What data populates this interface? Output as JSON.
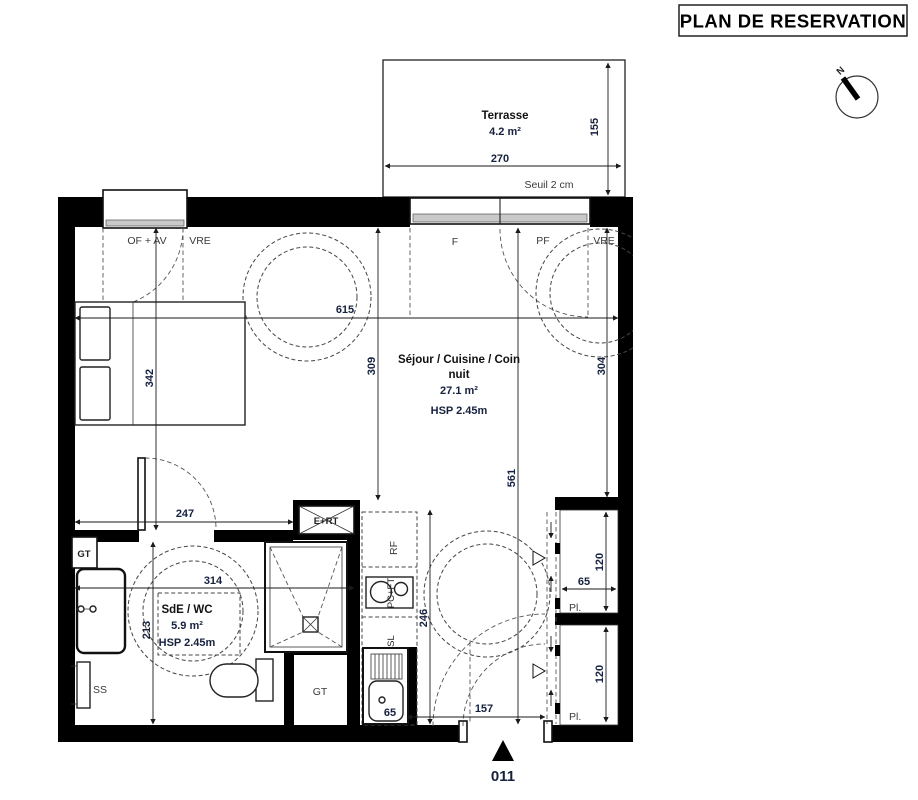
{
  "title": "PLAN DE RESERVATION",
  "compass": {
    "north": "N"
  },
  "terrace": {
    "name": "Terrasse",
    "area": "4.2 m²",
    "dim_width": "270",
    "dim_depth": "155",
    "sill": "Seuil 2 cm"
  },
  "openings": {
    "of_av": "OF + AV",
    "vre_left": "VRE",
    "f": "F",
    "pf": "PF",
    "vre_right": "VRE"
  },
  "living": {
    "name_line1": "Séjour / Cuisine / Coin",
    "name_line2": "nuit",
    "area": "27.1 m²",
    "ceiling": "HSP 2.45m",
    "dim_width": "615",
    "dim_bed": "342",
    "dim_left": "309",
    "dim_right": "304",
    "dim_depth": "561"
  },
  "bathroom": {
    "name": "SdE / WC",
    "area": "5.9 m²",
    "ceiling": "HSP 2.45m",
    "dim_top": "247",
    "dim_width": "314",
    "dim_depth": "213"
  },
  "kitchen": {
    "fridge": "RF",
    "cooktop": "PC+FT",
    "laundry": "SL",
    "sink_width": "65"
  },
  "hall": {
    "dim_depth": "246",
    "dim_width": "157"
  },
  "closets": {
    "top_label": "Pl.",
    "bottom_label": "Pl.",
    "dim_top": "120",
    "dim_width": "65",
    "dim_bottom": "120"
  },
  "technical": {
    "gt_upper": "GT",
    "gt_lower": "GT",
    "towel": "SS",
    "duct": "E+RT"
  },
  "entrance": {
    "number": "011"
  }
}
